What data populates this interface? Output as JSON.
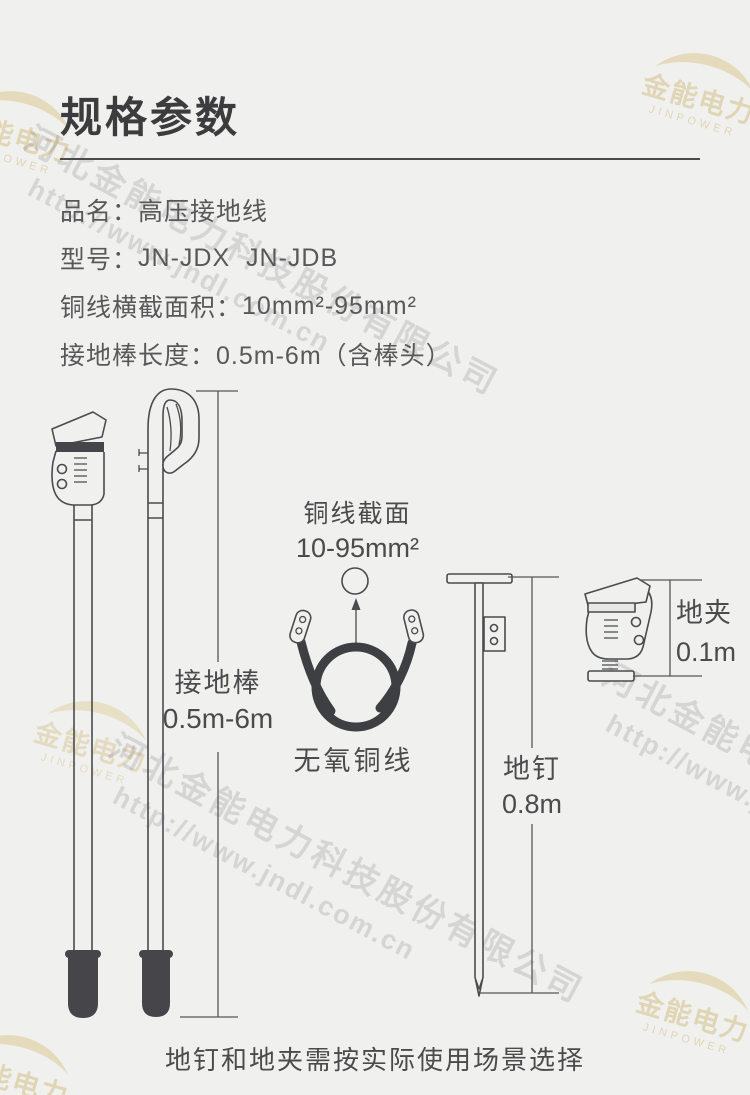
{
  "page": {
    "title": "规格参数",
    "footer_note": "地钉和地夹需按实际使用场景选择"
  },
  "specs": [
    {
      "label": "品名：",
      "value": "高压接地线"
    },
    {
      "label": "型号：",
      "value": "JN-JDX  JN-JDB"
    },
    {
      "label": "铜线横截面积：",
      "value": "10mm²-95mm²"
    },
    {
      "label": "接地棒长度：",
      "value": "0.5m-6m（含棒头）"
    }
  ],
  "diagram": {
    "rod_label": "接地棒",
    "rod_range": "0.5m-6m",
    "wire_section_label": "铜线截面",
    "wire_section_range": "10-95mm²",
    "wire_name": "无氧铜线",
    "nail_label": "地钉",
    "nail_length": "0.8m",
    "clamp_label": "地夹",
    "clamp_length": "0.1m"
  },
  "watermark": {
    "company": "河北金能电力科技股份有限公司",
    "url": "http://www.jndl.com.cn",
    "brand": "金能电力",
    "brand_en": "JINPOWER"
  },
  "colors": {
    "background": "#f0f0ee",
    "ink": "#4a4b4f",
    "text": "#58585a",
    "dark_fill": "#46464a",
    "watermark_gold": "#c8ac5f",
    "watermark_gray": "#5f5f66"
  }
}
